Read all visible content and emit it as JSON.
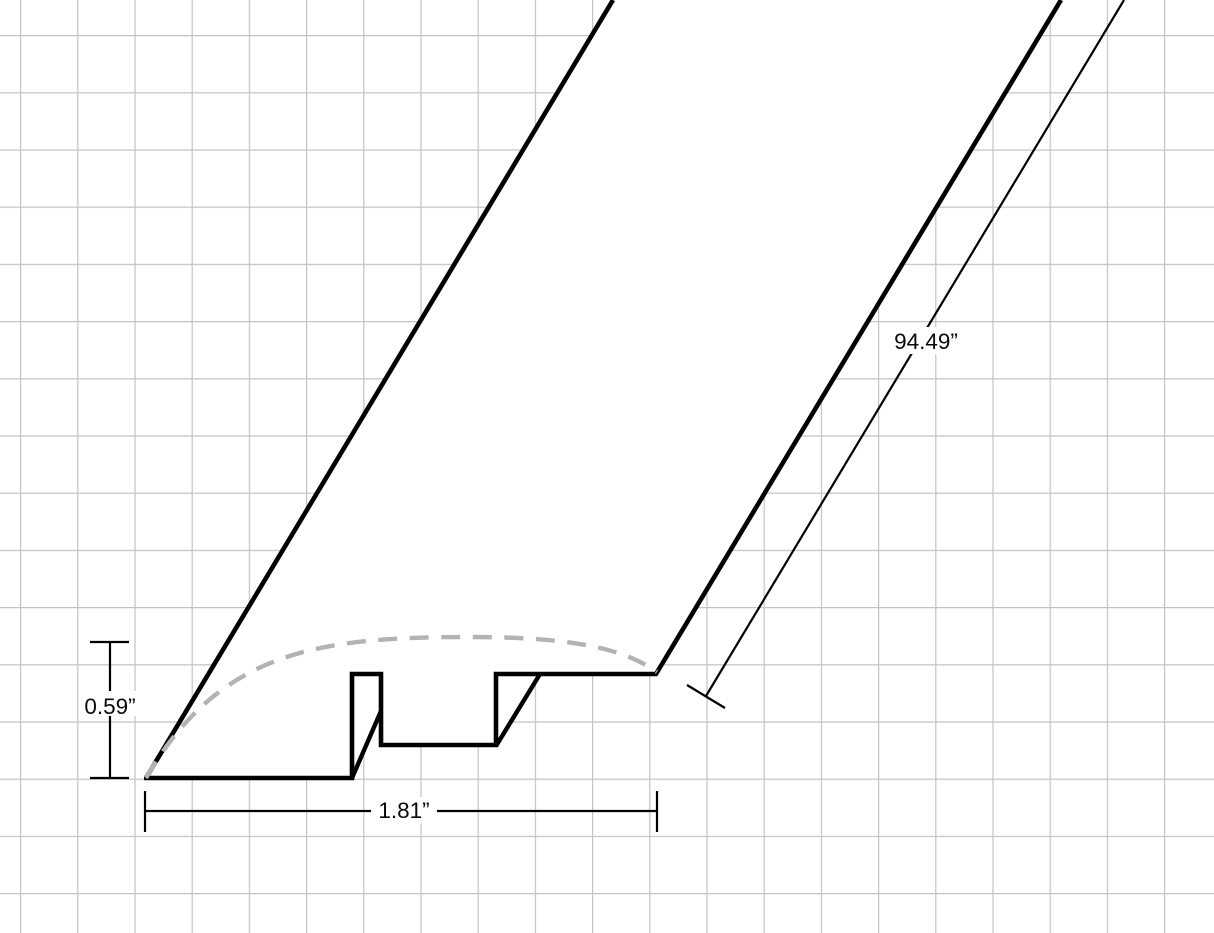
{
  "labels": {
    "height": "0.59”",
    "width": "1.81”",
    "length": "94.49”"
  },
  "colors": {
    "line": "#000000",
    "dashed_profile": "#b3b3b3",
    "grid": "#c3c3c3",
    "background": "#ffffff"
  }
}
